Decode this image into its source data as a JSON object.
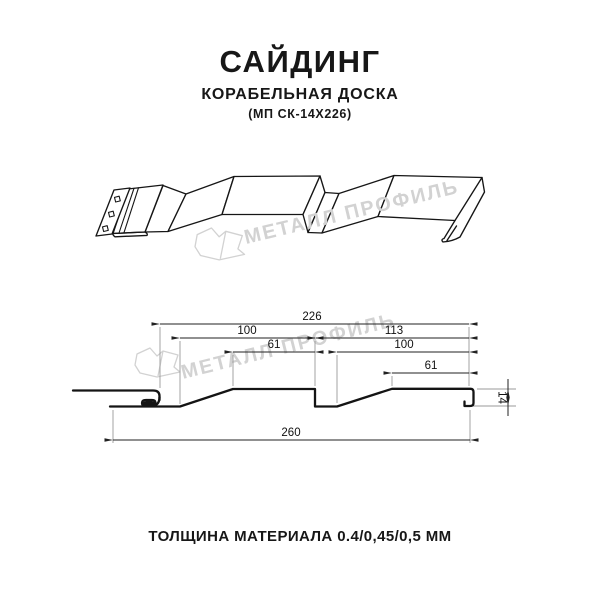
{
  "header": {
    "title": "САЙДИНГ",
    "subtitle": "КОРАБЕЛЬНАЯ ДОСКА",
    "model_code": "(МП СК-14Х226)"
  },
  "watermark": {
    "brand": "МЕТАЛЛ ПРОФИЛЬ"
  },
  "drawing": {
    "dimensions": {
      "cover_width": "226",
      "left_module": "100",
      "right_module": "113",
      "left_flat": "61",
      "right_overlap": "100",
      "right_flat": "61",
      "profile_height": "14",
      "overall_width": "260"
    }
  },
  "footer": {
    "thickness_note": "ТОЛЩИНА МАТЕРИАЛА 0.4/0,45/0,5 ММ"
  }
}
